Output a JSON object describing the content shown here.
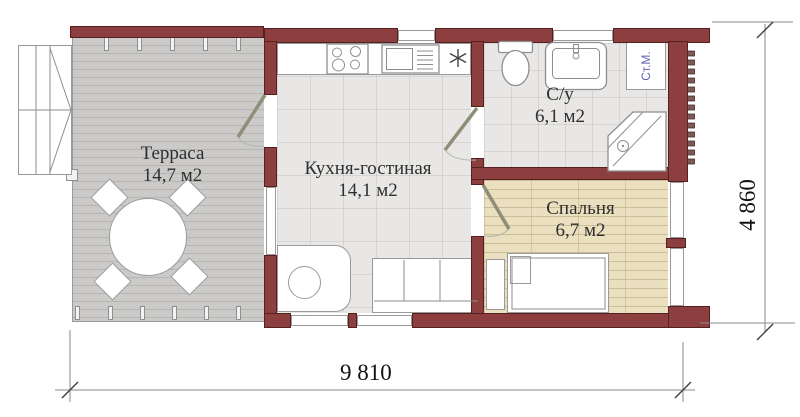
{
  "rooms": {
    "terrace": {
      "name": "Терраса",
      "area": "14,7 м2"
    },
    "kitchen": {
      "name": "Кухня-гостиная",
      "area": "14,1 м2"
    },
    "bathroom": {
      "name": "С/у",
      "area": "6,1 м2"
    },
    "bedroom": {
      "name": "Спальня",
      "area": "6,7 м2"
    }
  },
  "appliances": {
    "washing_machine_label": "Ст.М."
  },
  "dimensions": {
    "overall_width_mm": "9 810",
    "overall_depth_mm": "4 860"
  },
  "colors": {
    "wall": "#8c3f3e",
    "deck": "#cbcac8",
    "tile": "#e8e7e5",
    "wood": "#eadfbe",
    "door_leaf": "#8f8f78",
    "dimension_line": "#8a8a8a",
    "washing_machine_text": "#5e5eb5"
  }
}
